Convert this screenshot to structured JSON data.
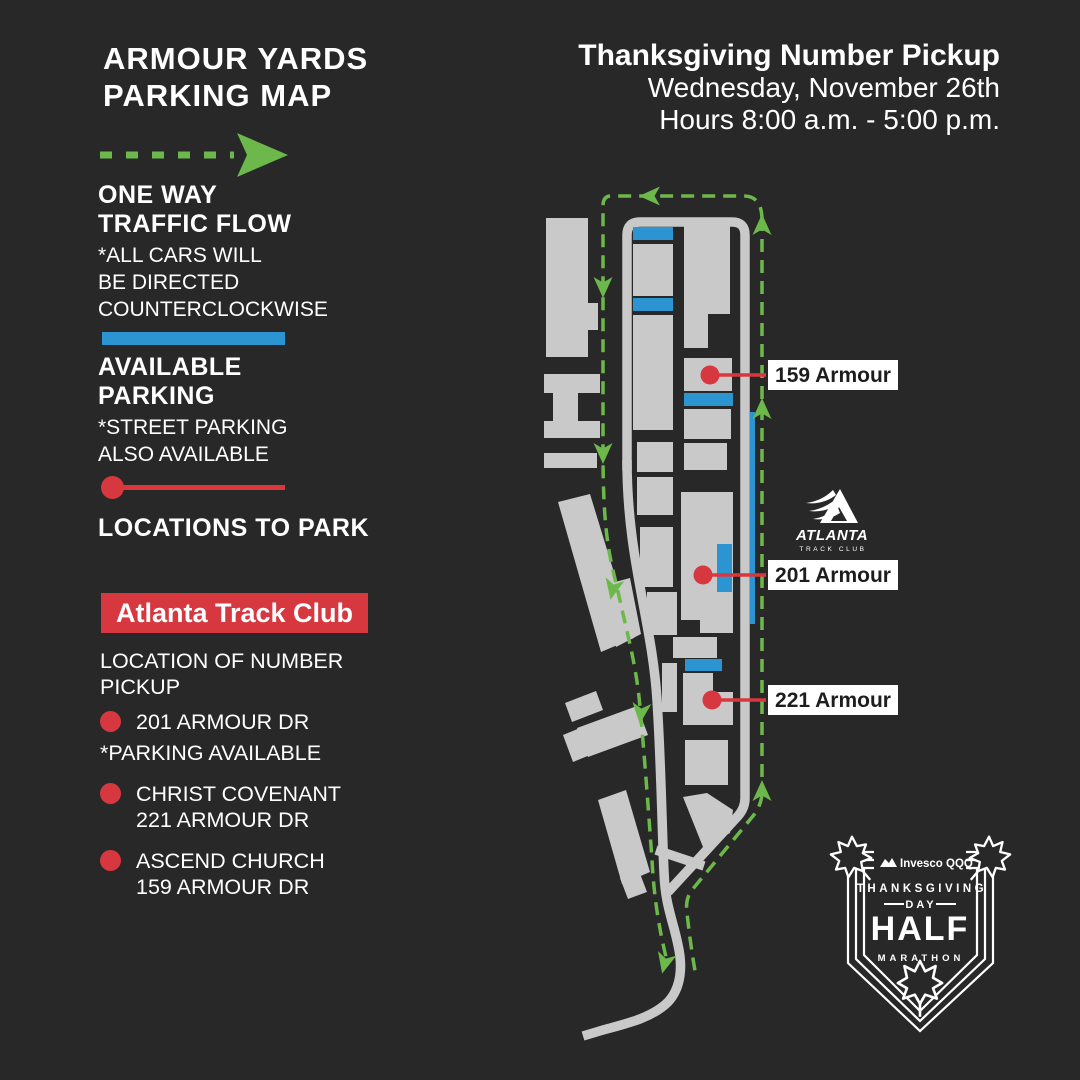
{
  "colors": {
    "bg": "#282828",
    "gray": "#c9c9c9",
    "green": "#6cb84a",
    "blue": "#2b94d1",
    "red": "#d73840",
    "white": "#ffffff",
    "ink": "#1d1d1d"
  },
  "title": "ARMOUR YARDS\nPARKING MAP",
  "header": {
    "line1": "Thanksgiving Number Pickup",
    "line2": "Wednesday, November 26th",
    "line3": "Hours 8:00 a.m. - 5:00 p.m."
  },
  "legend": {
    "one_way_label": "ONE WAY\nTRAFFIC FLOW",
    "one_way_note": "*ALL CARS WILL\nBE DIRECTED\nCOUNTERCLOCKWISE",
    "parking_label": "AVAILABLE\nPARKING",
    "parking_note": "*STREET PARKING\nALSO AVAILABLE",
    "locations_label": "LOCATIONS TO PARK"
  },
  "pickup": {
    "club": "Atlanta Track Club",
    "header": "LOCATION OF NUMBER PICKUP",
    "items": [
      {
        "line1": "201 ARMOUR DR",
        "note": "*PARKING AVAILABLE"
      },
      {
        "line1": "CHRIST COVENANT\n221 ARMOUR DR"
      },
      {
        "line1": "ASCEND CHURCH\n159 ARMOUR DR"
      }
    ]
  },
  "map": {
    "labels": [
      "159 Armour",
      "201 Armour",
      "221 Armour"
    ],
    "atc_logo": {
      "name": "ATLANTA",
      "sub": "TRACK CLUB"
    }
  },
  "marathon_logo": {
    "sponsor": "Invesco QQQ",
    "line1": "THANKSGIVING",
    "line2": "DAY",
    "line3": "HALF",
    "line4": "MARATHON"
  }
}
